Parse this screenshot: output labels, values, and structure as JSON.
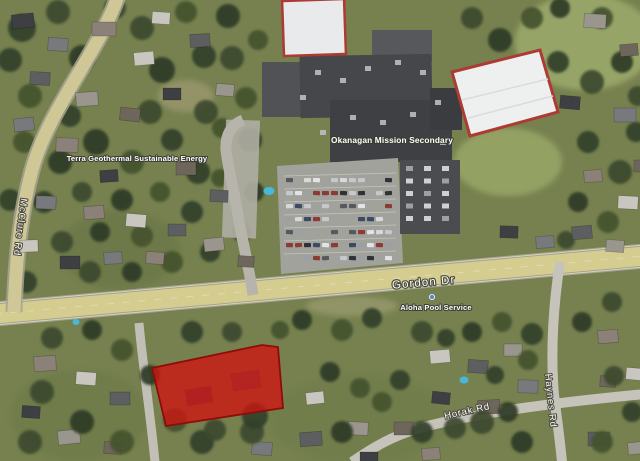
{
  "labels": {
    "school": "Okanagan Mission Secondary",
    "terra_geothermal": "Terra Geothermal Sustainable Energy",
    "aloha_pool": "Aloha Pool Service",
    "gordon_dr": "Gordon Dr",
    "mcclure_rd": "McClure Rd",
    "horak_rd": "Horak Rd",
    "haynes_rd": "Haynes Rd"
  },
  "highlight_parcel": {
    "fill": "#ce1511",
    "stroke": "#8f0c09",
    "opacity": "0.78"
  },
  "poi_marker": {
    "dot_color": "#4a8fd4"
  }
}
